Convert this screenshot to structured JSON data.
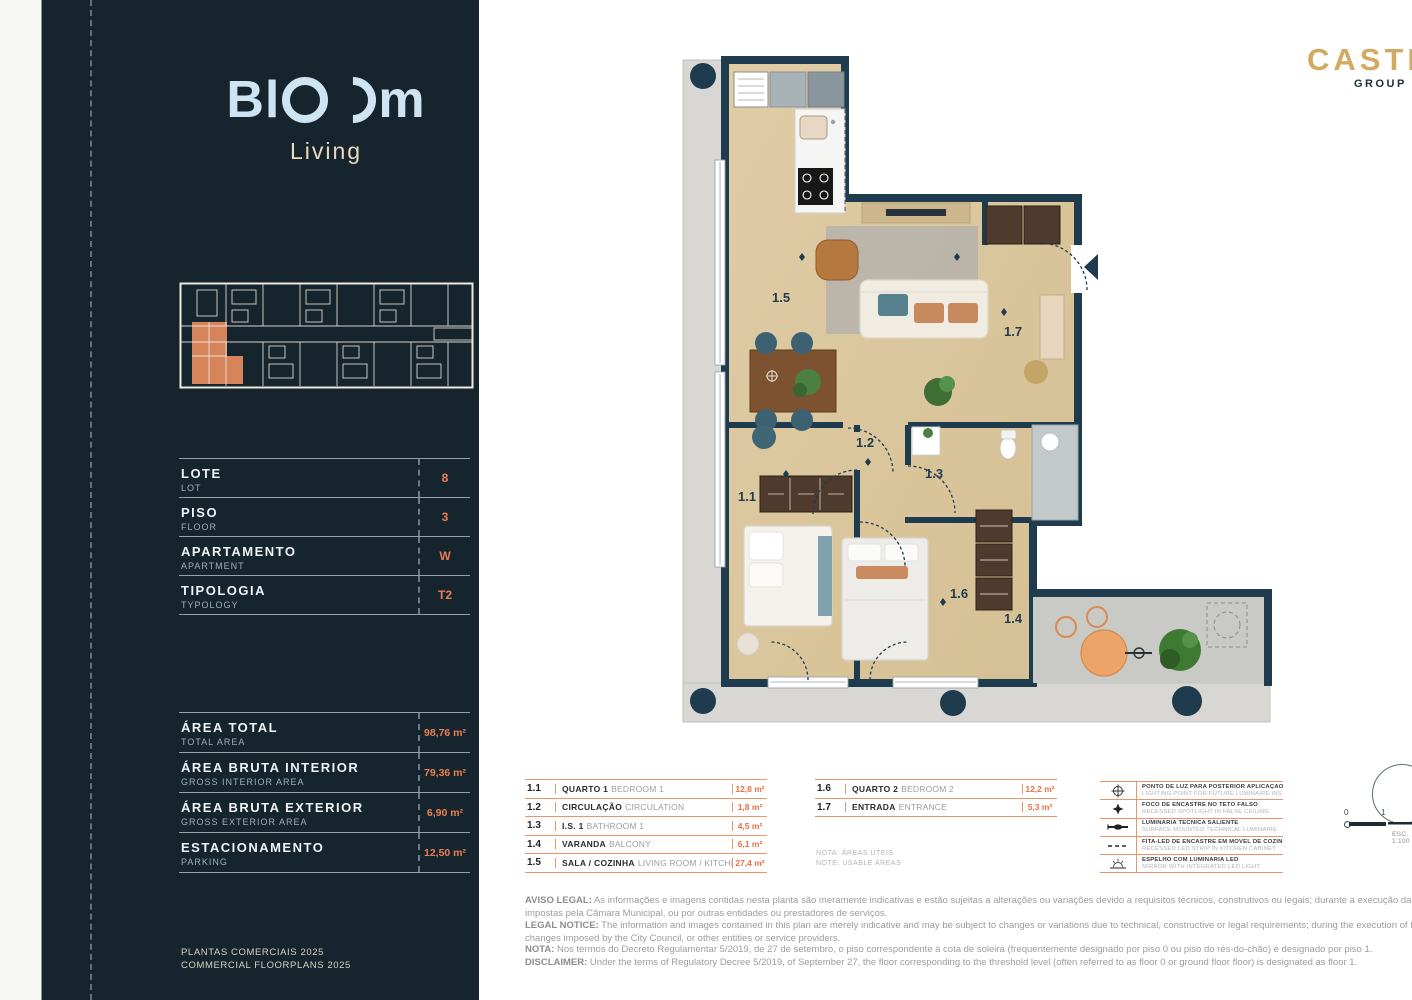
{
  "brand": {
    "logo_prefix": "Bl",
    "logo_suffix": "m",
    "logo_sub": "Living"
  },
  "partner": {
    "name": "CASTRO",
    "sub": "GROUP"
  },
  "sidebar": {
    "info_rows": [
      {
        "label": "LOTE",
        "sublabel": "LOT",
        "value": "8"
      },
      {
        "label": "PISO",
        "sublabel": "FLOOR",
        "value": "3"
      },
      {
        "label": "APARTAMENTO",
        "sublabel": "APARTMENT",
        "value": "W"
      },
      {
        "label": "TIPOLOGIA",
        "sublabel": "TYPOLOGY",
        "value": "T2"
      }
    ],
    "area_rows": [
      {
        "label": "ÁREA TOTAL",
        "sublabel": "TOTAL AREA",
        "value": "98,76 m²"
      },
      {
        "label": "ÁREA BRUTA INTERIOR",
        "sublabel": "GROSS INTERIOR AREA",
        "value": "79,36 m²"
      },
      {
        "label": "ÁREA BRUTA EXTERIOR",
        "sublabel": "GROSS EXTERIOR AREA",
        "value": "6,90 m²"
      },
      {
        "label": "ESTACIONAMENTO",
        "sublabel": "PARKING",
        "value": "12,50 m²"
      }
    ],
    "footer_line1": "PLANTAS COMERCIAIS 2025",
    "footer_line2": "COMMERCIAL FLOORPLANS 2025"
  },
  "plan": {
    "labels": {
      "r11": "1.1",
      "r12": "1.2",
      "r13": "1.3",
      "r14": "1.4",
      "r15": "1.5",
      "r16": "1.6",
      "r17": "1.7"
    }
  },
  "legend": {
    "table1": [
      {
        "code": "1.1",
        "pt": "QUARTO 1",
        "en": "BEDROOM 1",
        "area": "12,8 m²"
      },
      {
        "code": "1.2",
        "pt": "CIRCULAÇÃO",
        "en": "CIRCULATION",
        "area": "1,8 m²"
      },
      {
        "code": "1.3",
        "pt": "I.S. 1",
        "en": "BATHROOM 1",
        "area": "4,5 m²"
      },
      {
        "code": "1.4",
        "pt": "VARANDA",
        "en": "BALCONY",
        "area": "6,1 m²"
      },
      {
        "code": "1.5",
        "pt": "SALA / COZINHA",
        "en": "LIVING ROOM / KITCHEN",
        "area": "27,4 m²"
      }
    ],
    "table2": [
      {
        "code": "1.6",
        "pt": "QUARTO 2",
        "en": "BEDROOM 2",
        "area": "12,2 m²"
      },
      {
        "code": "1.7",
        "pt": "ENTRADA",
        "en": "ENTRANCE",
        "area": "5,3 m²"
      }
    ],
    "note_pt": "NOTA: ÁREAS ÚTEIS",
    "note_en": "NOTE: USABLE AREAS",
    "symbols": [
      {
        "pt": "PONTO DE LUZ PARA POSTERIOR APLICAÇÃO DE LUMINÁRIA",
        "en": "LIGHTING POINT FOR FUTURE LUMINAIRE INSTALLATION"
      },
      {
        "pt": "FOCO DE ENCASTRE NO TETO FALSO",
        "en": "RECESSED SPOTLIGHT IN FALSE CEILING"
      },
      {
        "pt": "LUMINÁRIA TÉCNICA SALIENTE",
        "en": "SURFACE-MOUNTED TECHNICAL LUMINAIRE"
      },
      {
        "pt": "FITA-LED DE ENCASTRE EM MÓVEL DE COZINHA",
        "en": "RECESSED LED STRIP IN KITCHEN CABINET"
      },
      {
        "pt": "ESPELHO COM LUMINÁRIA LED",
        "en": "MIRROR WITH INTEGRATED LED LIGHT"
      }
    ]
  },
  "scale": {
    "zero": "0",
    "one": "1",
    "esc": "ESC. 1:100"
  },
  "disclaimer": {
    "aviso_label": "AVISO LEGAL:",
    "aviso_text": " As informações e imagens contidas nesta planta são meramente indicativas e estão sujeitas a alterações ou variações devido a requisitos técnicos, construtivos ou legais; durante a execução da obra a promotora poderá implementar alterações impostas pela Câmara Municipal, ou por outras entidades ou prestadores de serviços.",
    "legal_label": "LEGAL NOTICE:",
    "legal_text": " The information and images contained in this plan are merely indicative and may be subject to changes or variations due to technical, constructive or legal requirements; during the execution of the work the developer may have to implement changes imposed by the City Council, or other entities or service providers.",
    "nota_label": "NOTA:",
    "nota_text": " Nos termos do Decreto Regulamentar 5/2019, de 27 de setembro, o piso correspondente à cota de soleira (frequentemente designado por piso 0 ou piso do rés-do-chão) é designado por piso 1.",
    "disc_label": "DISCLAIMER:",
    "disc_text": " Under the terms of Regulatory Decree 5/2019, of September 27, the floor corresponding to the threshold level (often referred to as floor 0 or ground floor floor) is designated as floor 1."
  },
  "colors": {
    "accent_orange": "#E87E50",
    "navy_wall": "#1E3C4E",
    "sidebar_bg": "#16242E",
    "gold": "#D2AA62"
  }
}
